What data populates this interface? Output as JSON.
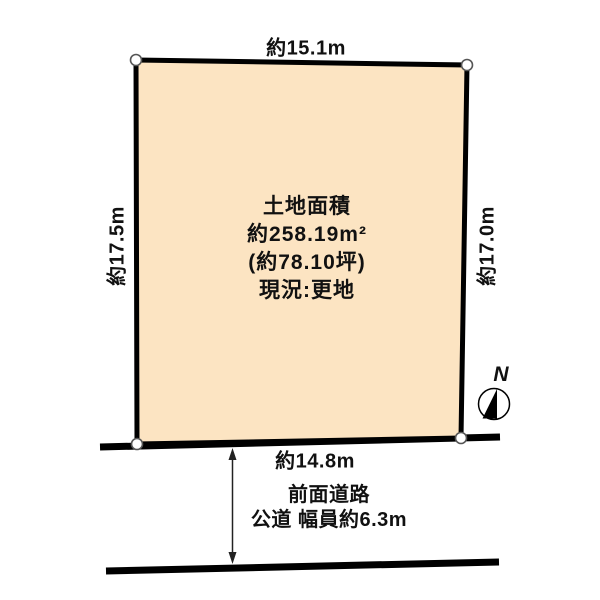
{
  "diagram": {
    "plot": {
      "area_label": "土地面積",
      "area_sqm": "約258.19m²",
      "area_tsubo": "(約78.10坪)",
      "status": "現況:更地",
      "fill_color": "#FCE4C2"
    },
    "dimensions": {
      "top": "約15.1m",
      "left": "約17.5m",
      "right": "約17.0m",
      "bottom": "約14.8m"
    },
    "road": {
      "name": "前面道路",
      "detail": "公道 幅員約6.3m"
    },
    "compass": {
      "label": "N"
    },
    "colors": {
      "line": "#000000",
      "corner_marker_stroke": "#555555"
    }
  }
}
